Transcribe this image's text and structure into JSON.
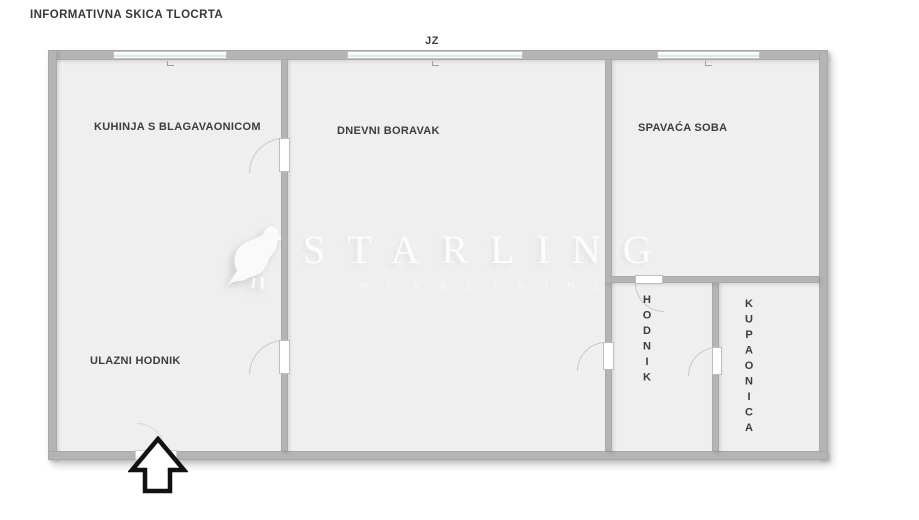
{
  "title": "INFORMATIVNA SKICA TLOCRTA",
  "compass": {
    "label": "JZ"
  },
  "rooms": {
    "kitchen": {
      "label": "KUHINJA S BLAGAVAONICOM"
    },
    "living_room": {
      "label": "DNEVNI BORAVAK"
    },
    "bedroom": {
      "label": "SPAVAĆA SOBA"
    },
    "entry_hall": {
      "label": "ULAZNI HODNIK"
    },
    "hallway": {
      "label": "HODNIK"
    },
    "bathroom": {
      "label": "KUPAONICA"
    }
  },
  "watermark": {
    "brand": "STARLING",
    "subtitle": "NEKRETNINE"
  },
  "colors": {
    "floor": "#efeff0",
    "wall": "#b4b4b4",
    "window_glass": "#dde8e9",
    "label_text": "#3d3d3d",
    "watermark_text": "#ffffff",
    "arrow_outline": "#111111"
  }
}
